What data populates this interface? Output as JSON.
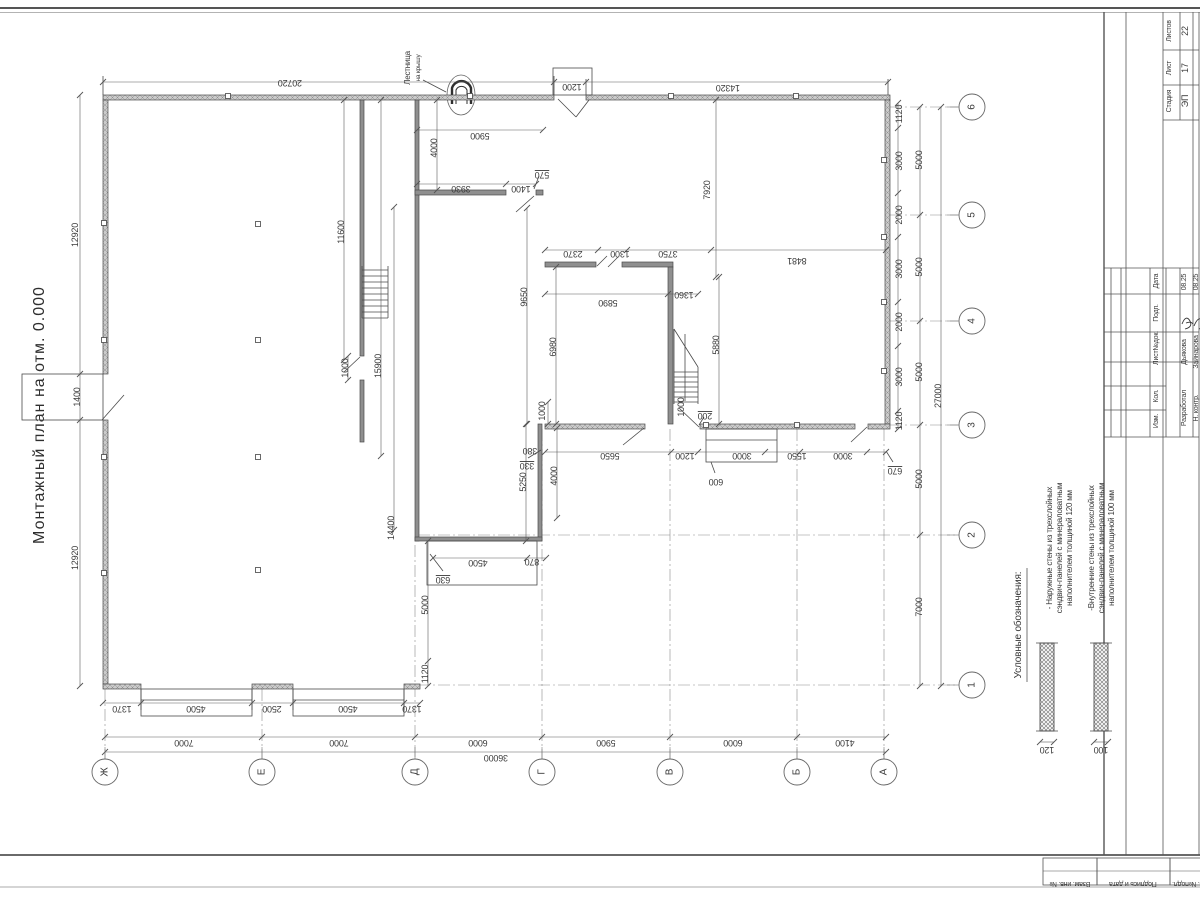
{
  "title": "Монтажный план на отм. 0.000",
  "stamp": {
    "stage_label": "Стадия",
    "stage": "ЭП",
    "sheet_label": "Лист",
    "sheet_no": "17",
    "sheets_label": "Листов",
    "sheets_total": "22",
    "header_cols": [
      "Изм.",
      "Кол.",
      "Лист№док.",
      "Подп.",
      "Дата"
    ],
    "rows": [
      {
        "role": "Разработал",
        "name": "Дьякова",
        "date": "08.25"
      },
      {
        "role": "Н. контр.",
        "name": "Зайнарова",
        "date": "08.25"
      }
    ],
    "side_boxes": [
      "Взам. инв. №",
      "Подпись и дата",
      "Инв. №подл."
    ]
  },
  "legend": {
    "heading": "Условные обозначения:",
    "items": [
      {
        "lines": [
          "- Наружные стены из трехслойных",
          "сэндвич-панелей с минераловатным",
          "наполнителем толщиной 120 мм"
        ],
        "thickness": "120"
      },
      {
        "lines": [
          "-Внутренние стены из трехслойных",
          "сэндвич-панелей с минераловатным",
          "наполнителем толщиной 100 мм"
        ],
        "thickness": "100"
      }
    ]
  },
  "plan": {
    "ladder_note": {
      "line1": "Лестница",
      "line2": "на крышу"
    },
    "axis_letters": [
      [
        "Ж",
        105
      ],
      [
        "Е",
        262
      ],
      [
        "Д",
        415
      ],
      [
        "Г",
        542
      ],
      [
        "В",
        670
      ],
      [
        "Б",
        797
      ],
      [
        "А",
        884
      ]
    ],
    "axis_letter_y": 772,
    "axis_numbers": [
      [
        "6",
        107
      ],
      [
        "5",
        215
      ],
      [
        "4",
        321
      ],
      [
        "3",
        425
      ],
      [
        "2",
        535
      ],
      [
        "1",
        685
      ]
    ],
    "axis_number_x": 972,
    "walls": [
      [
        103,
        95,
        451,
        5,
        "e"
      ],
      [
        586,
        95,
        304,
        5,
        "e"
      ],
      [
        103,
        100,
        5,
        274,
        "e"
      ],
      [
        103,
        420,
        5,
        264,
        "e"
      ],
      [
        103,
        684,
        38,
        5,
        "e"
      ],
      [
        252,
        684,
        41,
        5,
        "e"
      ],
      [
        404,
        684,
        16,
        5,
        "e"
      ],
      [
        885,
        100,
        5,
        324,
        "e"
      ],
      [
        545,
        424,
        100,
        5,
        "e"
      ],
      [
        700,
        424,
        155,
        5,
        "e"
      ],
      [
        868,
        424,
        22,
        5,
        "e"
      ],
      [
        415,
        100,
        4,
        441,
        "i"
      ],
      [
        360,
        100,
        4,
        256,
        "i"
      ],
      [
        360,
        380,
        4,
        62,
        "i"
      ],
      [
        415,
        190,
        91,
        5,
        "i"
      ],
      [
        536,
        190,
        7,
        5,
        "i"
      ],
      [
        545,
        262,
        51,
        5,
        "i"
      ],
      [
        622,
        262,
        51,
        5,
        "i"
      ],
      [
        668,
        267,
        5,
        157,
        "i"
      ],
      [
        538,
        424,
        4,
        117,
        "i"
      ],
      [
        415,
        537,
        127,
        4,
        "i"
      ]
    ],
    "rects": [
      [
        553,
        68,
        39,
        27
      ],
      [
        22,
        374,
        81,
        46
      ],
      [
        141,
        689,
        111,
        27
      ],
      [
        293,
        689,
        111,
        27
      ],
      [
        427,
        541,
        110,
        44
      ],
      [
        706,
        429,
        71,
        33
      ]
    ],
    "lines": [
      [
        362,
        266,
        362,
        318
      ],
      [
        388,
        266,
        388,
        318
      ],
      [
        362,
        270,
        388,
        270
      ],
      [
        362,
        276,
        388,
        276
      ],
      [
        362,
        282,
        388,
        282
      ],
      [
        362,
        288,
        388,
        288
      ],
      [
        362,
        294,
        388,
        294
      ],
      [
        362,
        300,
        388,
        300
      ],
      [
        362,
        306,
        388,
        306
      ],
      [
        362,
        312,
        388,
        312
      ],
      [
        362,
        318,
        388,
        318
      ],
      [
        674,
        329,
        698,
        367
      ],
      [
        674,
        329,
        674,
        404
      ],
      [
        698,
        367,
        698,
        404
      ],
      [
        674,
        372,
        698,
        372
      ],
      [
        674,
        377,
        698,
        377
      ],
      [
        674,
        382,
        698,
        382
      ],
      [
        674,
        387,
        698,
        387
      ],
      [
        674,
        392,
        698,
        392
      ],
      [
        674,
        397,
        698,
        397
      ],
      [
        674,
        402,
        698,
        402
      ],
      [
        685,
        334,
        685,
        401
      ],
      [
        558,
        99,
        576,
        117
      ],
      [
        576,
        117,
        589,
        100
      ],
      [
        102,
        420,
        124,
        395
      ],
      [
        360,
        357,
        344,
        372
      ],
      [
        534,
        196,
        516,
        212
      ],
      [
        699,
        427,
        679,
        408
      ],
      [
        644,
        428,
        623,
        445
      ],
      [
        867,
        427,
        851,
        442
      ],
      [
        539,
        176,
        534,
        189
      ],
      [
        443,
        571,
        430,
        554
      ],
      [
        704,
        417,
        699,
        425
      ],
      [
        715,
        473,
        711,
        462
      ],
      [
        528,
        458,
        541,
        450
      ],
      [
        893,
        462,
        886,
        451
      ],
      [
        423,
        80,
        446,
        92
      ],
      [
        597,
        266,
        607,
        256
      ],
      [
        608,
        267,
        618,
        257
      ],
      [
        141,
        700,
        252,
        700
      ],
      [
        293,
        700,
        404,
        700
      ],
      [
        706,
        440,
        777,
        440
      ],
      [
        141,
        689,
        141,
        710
      ],
      [
        252,
        689,
        252,
        710
      ],
      [
        293,
        689,
        293,
        710
      ],
      [
        404,
        689,
        404,
        710
      ],
      [
        103,
        95,
        103,
        76
      ],
      [
        554,
        95,
        554,
        76
      ],
      [
        586,
        95,
        586,
        79
      ],
      [
        888,
        95,
        888,
        79
      ],
      [
        1036,
        643,
        1058,
        643
      ],
      [
        1036,
        731,
        1058,
        731
      ],
      [
        1090,
        643,
        1112,
        643
      ],
      [
        1090,
        731,
        1112,
        731
      ]
    ],
    "dashlines": [
      [
        890,
        107,
        958,
        107
      ],
      [
        890,
        215,
        958,
        215
      ],
      [
        890,
        321,
        958,
        321
      ],
      [
        890,
        425,
        958,
        425
      ],
      [
        418,
        535,
        958,
        535
      ],
      [
        418,
        685,
        958,
        685
      ],
      [
        105,
        689,
        105,
        759
      ],
      [
        262,
        689,
        262,
        759
      ],
      [
        415,
        545,
        415,
        759
      ],
      [
        542,
        429,
        542,
        759
      ],
      [
        670,
        429,
        670,
        759
      ],
      [
        797,
        429,
        797,
        759
      ],
      [
        884,
        429,
        884,
        759
      ]
    ],
    "dimlines": [
      [
        "h",
        82,
        103,
        888,
        [
          103,
          554,
          586,
          888
        ]
      ],
      [
        "h",
        130,
        417,
        543,
        [
          417,
          543
        ]
      ],
      [
        "h",
        184,
        417,
        536,
        [
          417,
          506,
          536
        ]
      ],
      [
        "h",
        250,
        545,
        886,
        [
          545,
          598,
          627,
          711,
          886
        ]
      ],
      [
        "h",
        294,
        545,
        698,
        [
          545,
          668,
          698
        ]
      ],
      [
        "h",
        452,
        545,
        886,
        [
          545,
          671,
          698,
          765,
          800,
          867,
          886
        ]
      ],
      [
        "h",
        558,
        433,
        546,
        [
          433,
          527,
          546
        ]
      ],
      [
        "h",
        703,
        103,
        420,
        [
          103,
          141,
          252,
          293,
          404,
          420
        ]
      ],
      [
        "h",
        737,
        105,
        886,
        [
          105,
          262,
          415,
          542,
          670,
          797,
          886
        ]
      ],
      [
        "h",
        752,
        105,
        886,
        [
          105,
          886
        ]
      ],
      [
        "h",
        742,
        1040,
        1054,
        [
          1040,
          1054
        ]
      ],
      [
        "h",
        742,
        1094,
        1108,
        [
          1094,
          1108
        ]
      ],
      [
        "v",
        80,
        95,
        686,
        [
          95,
          374,
          420,
          686
        ]
      ],
      [
        "v",
        344,
        100,
        360,
        [
          100,
          360
        ]
      ],
      [
        "v",
        381,
        100,
        456,
        [
          100,
          456
        ]
      ],
      [
        "v",
        348,
        356,
        380,
        [
          356,
          380
        ]
      ],
      [
        "v",
        437,
        100,
        190,
        [
          100,
          190
        ]
      ],
      [
        "v",
        527,
        208,
        424,
        [
          208,
          424
        ]
      ],
      [
        "v",
        556,
        267,
        424,
        [
          267,
          424
        ]
      ],
      [
        "v",
        716,
        100,
        277,
        [
          100,
          277
        ]
      ],
      [
        "v",
        719,
        277,
        424,
        [
          277,
          424
        ]
      ],
      [
        "v",
        394,
        207,
        530,
        [
          207,
          530
        ]
      ],
      [
        "v",
        428,
        541,
        686,
        [
          541,
          661,
          686
        ]
      ],
      [
        "v",
        526,
        424,
        541,
        [
          424,
          541
        ]
      ],
      [
        "v",
        557,
        428,
        518,
        [
          428,
          518
        ]
      ],
      [
        "v",
        548,
        402,
        424,
        [
          402,
          424
        ]
      ],
      [
        "v",
        898,
        103,
        429,
        [
          103,
          128,
          193,
          237,
          302,
          346,
          411,
          429
        ]
      ],
      [
        "v",
        920,
        107,
        686,
        [
          107,
          215,
          321,
          425,
          535,
          686
        ]
      ],
      [
        "v",
        941,
        107,
        686,
        [
          107,
          686
        ]
      ]
    ],
    "dims": [
      [
        "20720",
        290,
        80,
        180
      ],
      [
        "1200",
        572,
        84,
        180
      ],
      [
        "14320",
        728,
        85,
        180
      ],
      [
        "5900",
        480,
        133,
        180
      ],
      [
        "4000",
        437,
        148,
        -90
      ],
      [
        "3930",
        461,
        186,
        180
      ],
      [
        "1400",
        521,
        186,
        180
      ],
      [
        "570",
        542,
        172,
        180,
        1
      ],
      [
        "12920",
        78,
        235,
        -90
      ],
      [
        "1400",
        80,
        397,
        -90
      ],
      [
        "12920",
        78,
        558,
        -90
      ],
      [
        "11600",
        344,
        232,
        -90
      ],
      [
        "15900",
        381,
        366,
        -90
      ],
      [
        "1000",
        348,
        368,
        -90
      ],
      [
        "2370",
        573,
        251,
        180
      ],
      [
        "1300",
        620,
        251,
        180
      ],
      [
        "3750",
        668,
        251,
        180
      ],
      [
        "8481",
        797,
        258,
        180
      ],
      [
        "7920",
        710,
        190,
        -90
      ],
      [
        "9650",
        527,
        297,
        -90
      ],
      [
        "5890",
        608,
        300,
        180
      ],
      [
        "1360",
        684,
        292,
        180
      ],
      [
        "5880",
        719,
        345,
        -90
      ],
      [
        "6980",
        556,
        347,
        -90
      ],
      [
        "14400",
        394,
        528,
        -90
      ],
      [
        "5250",
        526,
        482,
        -90
      ],
      [
        "4000",
        557,
        476,
        -90
      ],
      [
        "630",
        443,
        577,
        180,
        1
      ],
      [
        "4500",
        478,
        560,
        180
      ],
      [
        "870",
        532,
        559,
        180
      ],
      [
        "5000",
        428,
        605,
        -90
      ],
      [
        "1120",
        428,
        674,
        -90
      ],
      [
        "380",
        530,
        448,
        180
      ],
      [
        "330",
        527,
        463,
        180,
        1
      ],
      [
        "5650",
        610,
        453,
        180
      ],
      [
        "1200",
        685,
        453,
        180
      ],
      [
        "3000",
        742,
        453,
        180
      ],
      [
        "1550",
        797,
        453,
        180
      ],
      [
        "3000",
        843,
        453,
        180
      ],
      [
        "670",
        895,
        468,
        180,
        1
      ],
      [
        "600",
        716,
        479,
        180
      ],
      [
        "200",
        705,
        413,
        180,
        1
      ],
      [
        "1000",
        684,
        407,
        -90
      ],
      [
        "1000",
        545,
        411,
        -90
      ],
      [
        "1120",
        902,
        114,
        -90
      ],
      [
        "3000",
        902,
        161,
        -90
      ],
      [
        "2000",
        902,
        215,
        -90
      ],
      [
        "3000",
        902,
        269,
        -90
      ],
      [
        "2000",
        902,
        322,
        -90
      ],
      [
        "3000",
        902,
        377,
        -90
      ],
      [
        "1120",
        902,
        421,
        -90
      ],
      [
        "5000",
        922,
        160,
        -90
      ],
      [
        "5000",
        922,
        267,
        -90
      ],
      [
        "5000",
        922,
        372,
        -90
      ],
      [
        "5000",
        922,
        479,
        -90
      ],
      [
        "7000",
        922,
        607,
        -90
      ],
      [
        "27000",
        941,
        396,
        -90
      ],
      [
        "1370",
        122,
        706,
        180
      ],
      [
        "4500",
        196,
        706,
        180
      ],
      [
        "2500",
        272,
        706,
        180
      ],
      [
        "4500",
        348,
        706,
        180
      ],
      [
        "1370",
        412,
        706,
        180
      ],
      [
        "7000",
        184,
        740,
        180
      ],
      [
        "7000",
        339,
        740,
        180
      ],
      [
        "6000",
        478,
        740,
        180
      ],
      [
        "5900",
        606,
        740,
        180
      ],
      [
        "6000",
        733,
        740,
        180
      ],
      [
        "4100",
        845,
        740,
        180
      ],
      [
        "36000",
        496,
        755,
        180
      ],
      [
        "120",
        1047,
        747,
        180
      ],
      [
        "100",
        1101,
        747,
        180
      ]
    ],
    "squares": [
      [
        228,
        96
      ],
      [
        470,
        96
      ],
      [
        671,
        96
      ],
      [
        796,
        96
      ],
      [
        104,
        223
      ],
      [
        104,
        340
      ],
      [
        104,
        457
      ],
      [
        104,
        573
      ],
      [
        258,
        224
      ],
      [
        258,
        340
      ],
      [
        258,
        457
      ],
      [
        258,
        570
      ],
      [
        884,
        160
      ],
      [
        884,
        237
      ],
      [
        884,
        302
      ],
      [
        884,
        371
      ],
      [
        706,
        425
      ],
      [
        797,
        425
      ]
    ]
  }
}
